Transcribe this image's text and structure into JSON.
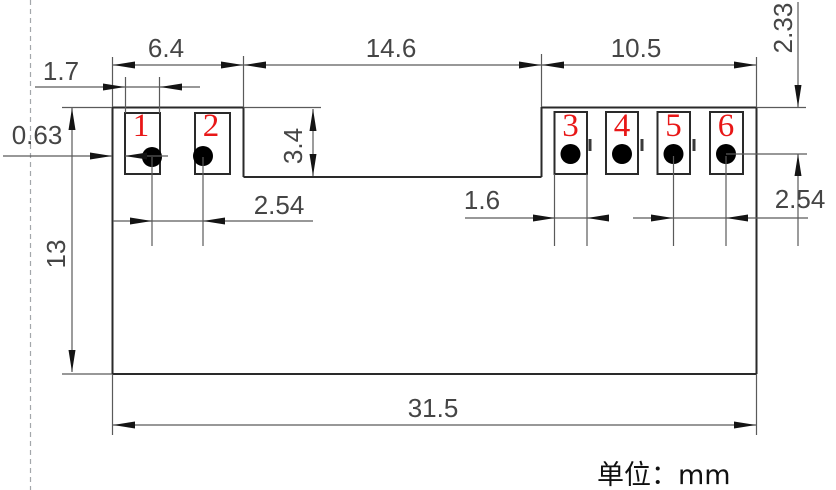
{
  "drawing": {
    "units_label": "单位：mm",
    "dims": {
      "pad_group_left_width": "6.4",
      "center_section_width": "14.6",
      "pad_group_right_width": "10.5",
      "pad1_width": "1.7",
      "left_edge_to_pad1": "0.63",
      "body_height": "13",
      "notch_depth": "3.4",
      "pitch_left": "2.54",
      "pad3_width": "1.6",
      "pitch_right": "2.54",
      "top_edge_to_hole_center": "2.33",
      "body_width": "31.5"
    },
    "pads": [
      {
        "number": "1"
      },
      {
        "number": "2"
      },
      {
        "number": "3"
      },
      {
        "number": "4"
      },
      {
        "number": "5"
      },
      {
        "number": "6"
      }
    ],
    "colors": {
      "part_line": "#2a2a2a",
      "dimension_line": "#5a5a5a",
      "dimension_text": "#454545",
      "pad_number": "#e81717",
      "dashed_margin": "#a3a7ab",
      "background": "#ffffff"
    }
  }
}
